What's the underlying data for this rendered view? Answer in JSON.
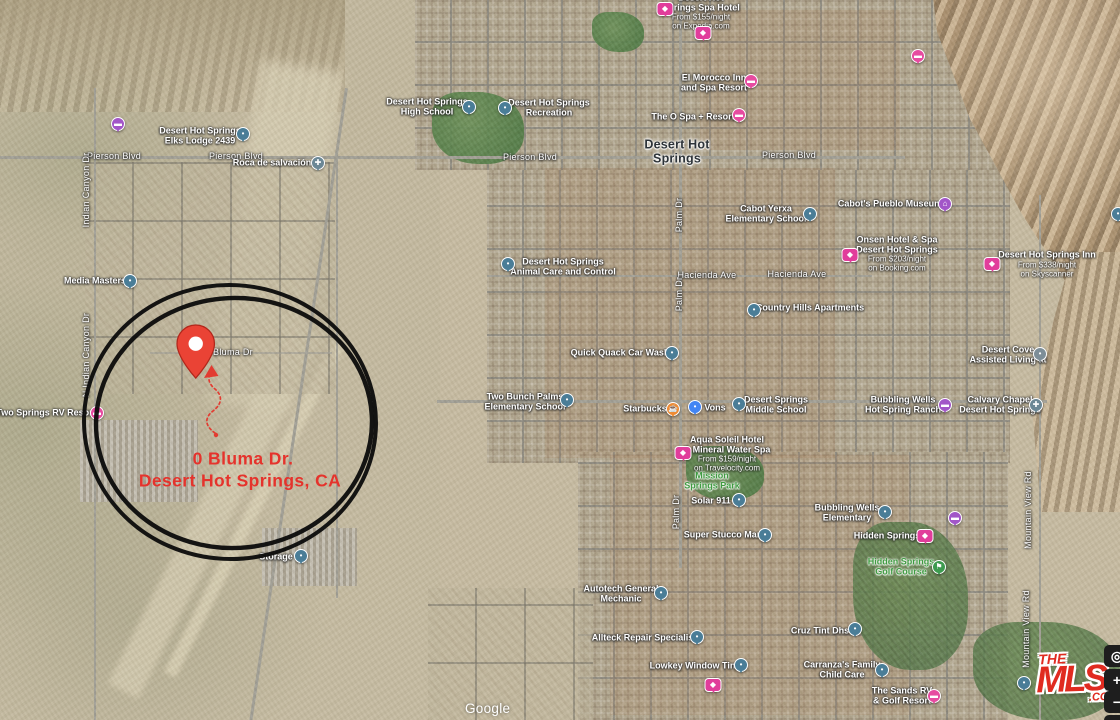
{
  "map": {
    "attribution": "Google",
    "city_label": {
      "lines": [
        "Desert Hot",
        "Springs"
      ]
    },
    "annotation": {
      "line1": "0 Bluma Dr.",
      "line2": "Desert Hot Springs, CA",
      "accent_color": "#e5332c",
      "marker_color": "#ea4335"
    },
    "logo": {
      "the": "THE",
      "mls": "MLS",
      "tm": "™",
      "com": ".COM",
      "color": "#e02b20"
    },
    "controls": {
      "zoom_in": "+",
      "zoom_out": "−"
    },
    "streets": [
      {
        "name": "Pierson Blvd",
        "x": 114,
        "y": 156
      },
      {
        "name": "Pierson Blvd",
        "x": 236,
        "y": 156
      },
      {
        "name": "Pierson Blvd",
        "x": 530,
        "y": 157
      },
      {
        "name": "Pierson Blvd",
        "x": 789,
        "y": 155
      },
      {
        "name": "Hacienda Ave",
        "x": 707,
        "y": 275
      },
      {
        "name": "Hacienda Ave",
        "x": 797,
        "y": 274
      },
      {
        "name": "Indian Canyon Dr",
        "x": 86,
        "y": 190,
        "v": true
      },
      {
        "name": "N Indian Canyon Dr",
        "x": 86,
        "y": 355,
        "v": true
      },
      {
        "name": "Palm Dr",
        "x": 679,
        "y": 215,
        "v": true
      },
      {
        "name": "Palm Dr",
        "x": 679,
        "y": 294,
        "v": true
      },
      {
        "name": "Palm Dr",
        "x": 676,
        "y": 512,
        "v": true
      },
      {
        "name": "Mountain View Rd",
        "x": 1028,
        "y": 510,
        "v": true
      },
      {
        "name": "Mountain View Rd",
        "x": 1026,
        "y": 629,
        "v": true
      },
      {
        "name": "Bluma Dr",
        "x": 233,
        "y": 352
      }
    ],
    "pois": [
      {
        "id": "elks-lodge",
        "lines": [
          "Desert Hot Springs",
          "Elks Lodge 2439"
        ],
        "x": 200,
        "y": 136,
        "pin": {
          "x": 243,
          "y": 134,
          "c": "#4a7d97",
          "g": "•"
        }
      },
      {
        "id": "roca-de-salvacion",
        "lines": [
          "Roca de salvación"
        ],
        "x": 272,
        "y": 163,
        "pin": {
          "x": 318,
          "y": 163,
          "c": "#6b8795",
          "g": "✚"
        }
      },
      {
        "id": "media-masters",
        "lines": [
          "Media Masters"
        ],
        "x": 95,
        "y": 281,
        "pin": {
          "x": 130,
          "y": 281,
          "c": "#4a7d97",
          "g": "•"
        }
      },
      {
        "id": "two-springs-rv-resort",
        "lines": [
          "Two Springs RV Resort"
        ],
        "x": 46,
        "y": 413,
        "pin": {
          "x": 97,
          "y": 413,
          "c": "#e64ba0",
          "g": "▬"
        }
      },
      {
        "id": "storage",
        "lines": [
          "Storage"
        ],
        "x": 276,
        "y": 557,
        "pin": {
          "x": 301,
          "y": 556,
          "c": "#4a7d97",
          "g": "•"
        }
      },
      {
        "id": "dhs-high-school",
        "lines": [
          "Desert Hot Springs",
          "High School"
        ],
        "x": 427,
        "y": 107,
        "pin": {
          "x": 469,
          "y": 107,
          "c": "#4a7d97",
          "g": "•"
        }
      },
      {
        "id": "dhs-recreation",
        "lines": [
          "Desert Hot Springs",
          "Recreation"
        ],
        "x": 549,
        "y": 108,
        "pin": {
          "x": 505,
          "y": 108,
          "c": "#4a7d97",
          "g": "•"
        }
      },
      {
        "id": "dhs-spa-hotel",
        "lines": [
          "Desert Hot",
          "Springs Spa Hotel"
        ],
        "sub": [
          "From $155/night",
          "on Expedia.com"
        ],
        "x": 701,
        "y": 12,
        "pin": {
          "x": 665,
          "y": 9,
          "c": "#e13d9b",
          "g": "◆",
          "sq": true
        }
      },
      {
        "id": "spa-hotel-2",
        "pin": {
          "x": 703,
          "y": 33,
          "c": "#e13d9b",
          "g": "◆",
          "sq": true
        }
      },
      {
        "id": "el-morocco-inn",
        "lines": [
          "El Morocco Inn",
          "and Spa Resort"
        ],
        "x": 714,
        "y": 83,
        "pin": {
          "x": 751,
          "y": 81,
          "c": "#e64ba0",
          "g": "▬"
        }
      },
      {
        "id": "the-o-spa",
        "lines": [
          "The O Spa + Resort"
        ],
        "x": 693,
        "y": 117,
        "pin": {
          "x": 739,
          "y": 115,
          "c": "#e64ba0",
          "g": "▬"
        }
      },
      {
        "id": "hotel-ne",
        "pin": {
          "x": 918,
          "y": 56,
          "c": "#e64ba0",
          "g": "▬"
        }
      },
      {
        "id": "cabots-pueblo-museum",
        "lines": [
          "Cabot's Pueblo Museum"
        ],
        "x": 890,
        "y": 204,
        "pin": {
          "x": 945,
          "y": 204,
          "c": "#a256c8",
          "g": "⌂"
        }
      },
      {
        "id": "cabot-yerxa-elementary",
        "lines": [
          "Cabot Yerxa",
          "Elementary School"
        ],
        "x": 766,
        "y": 214,
        "pin": {
          "x": 810,
          "y": 214,
          "c": "#4a7d97",
          "g": "•"
        }
      },
      {
        "id": "animal-care-control",
        "lines": [
          "Desert Hot Springs",
          "Animal Care and Control"
        ],
        "x": 563,
        "y": 267,
        "pin": {
          "x": 508,
          "y": 264,
          "c": "#4a7d97",
          "g": "•"
        }
      },
      {
        "id": "country-hills-apartments",
        "lines": [
          "Country Hills Apartments"
        ],
        "x": 810,
        "y": 308,
        "pin": {
          "x": 754,
          "y": 310,
          "c": "#4a7d97",
          "g": "•"
        }
      },
      {
        "id": "onsen-hotel-spa",
        "lines": [
          "Onsen Hotel & Spa",
          "Desert Hot Springs"
        ],
        "sub": [
          "From $203/night",
          "on Booking.com"
        ],
        "x": 897,
        "y": 254,
        "pin": {
          "x": 850,
          "y": 255,
          "c": "#e13d9b",
          "g": "◆",
          "sq": true
        }
      },
      {
        "id": "dhs-inn",
        "lines": [
          "Desert Hot Springs Inn"
        ],
        "sub": [
          "From $338/night",
          "on Skyscanner"
        ],
        "x": 1047,
        "y": 264,
        "pin": {
          "x": 992,
          "y": 264,
          "c": "#e13d9b",
          "g": "◆",
          "sq": true
        }
      },
      {
        "id": "quick-quack-car-wash",
        "lines": [
          "Quick Quack Car Wash"
        ],
        "x": 620,
        "y": 353,
        "pin": {
          "x": 672,
          "y": 353,
          "c": "#4a7d97",
          "g": "•"
        }
      },
      {
        "id": "two-bunch-palms-elementary",
        "lines": [
          "Two Bunch Palms",
          "Elementary School"
        ],
        "x": 525,
        "y": 402,
        "pin": {
          "x": 567,
          "y": 400,
          "c": "#4a7d97",
          "g": "•"
        }
      },
      {
        "id": "starbucks",
        "lines": [
          "Starbucks"
        ],
        "x": 645,
        "y": 409,
        "pin": {
          "x": 673,
          "y": 409,
          "c": "#ee8a33",
          "g": "☕"
        }
      },
      {
        "id": "vons",
        "lines": [
          "Vons"
        ],
        "x": 715,
        "y": 408,
        "pin": {
          "x": 695,
          "y": 407,
          "c": "#4285f4",
          "g": "•"
        }
      },
      {
        "id": "desert-springs-middle-school",
        "lines": [
          "Desert Springs",
          "Middle School"
        ],
        "x": 776,
        "y": 405,
        "pin": {
          "x": 739,
          "y": 404,
          "c": "#4a7d97",
          "g": "•"
        }
      },
      {
        "id": "desert-cove-assisted-living",
        "lines": [
          "Desert Cove",
          "Assisted Living at"
        ],
        "x": 1008,
        "y": 355,
        "pin": {
          "x": 1040,
          "y": 354,
          "c": "#7d8e98",
          "g": "•"
        }
      },
      {
        "id": "bubbling-wells-ranch",
        "lines": [
          "Bubbling Wells",
          "Hot Spring Ranch"
        ],
        "x": 903,
        "y": 405,
        "pin": {
          "x": 945,
          "y": 405,
          "c": "#a256c8",
          "g": "▬"
        }
      },
      {
        "id": "calvary-chapel",
        "lines": [
          "Calvary Chapel",
          "Desert Hot Springs"
        ],
        "x": 1000,
        "y": 405,
        "pin": {
          "x": 1036,
          "y": 405,
          "c": "#6b8795",
          "g": "✚"
        }
      },
      {
        "id": "aqua-soleil-hotel",
        "lines": [
          "Aqua Soleil Hotel",
          "& Mineral Water Spa"
        ],
        "sub": [
          "From $159/night",
          "on Travelocity.com"
        ],
        "x": 727,
        "y": 454,
        "pin": {
          "x": 683,
          "y": 453,
          "c": "#e13d9b",
          "g": "◆",
          "sq": true
        }
      },
      {
        "id": "mission-springs-park",
        "lines": [
          "Mission",
          "Springs Park"
        ],
        "x": 712,
        "y": 481,
        "cls": "greenlbl"
      },
      {
        "id": "solar-911",
        "lines": [
          "Solar 911"
        ],
        "x": 711,
        "y": 501,
        "pin": {
          "x": 739,
          "y": 500,
          "c": "#4a7d97",
          "g": "•"
        }
      },
      {
        "id": "super-stucco-man",
        "lines": [
          "Super Stucco Man"
        ],
        "x": 723,
        "y": 535,
        "pin": {
          "x": 765,
          "y": 535,
          "c": "#4a7d97",
          "g": "•"
        }
      },
      {
        "id": "bubbling-wells-elementary",
        "lines": [
          "Bubbling Wells",
          "Elementary"
        ],
        "x": 847,
        "y": 513,
        "pin": {
          "x": 885,
          "y": 512,
          "c": "#4a7d97",
          "g": "•"
        }
      },
      {
        "id": "hidden-springs",
        "lines": [
          "Hidden Springs"
        ],
        "x": 887,
        "y": 536,
        "pin": {
          "x": 925,
          "y": 536,
          "c": "#e13d9b",
          "g": "◆",
          "sq": true
        }
      },
      {
        "id": "lodging-hidden",
        "pin": {
          "x": 955,
          "y": 518,
          "c": "#a256c8",
          "g": "▬"
        }
      },
      {
        "id": "hidden-springs-golf",
        "lines": [
          "Hidden Springs",
          "Golf Course"
        ],
        "x": 901,
        "y": 567,
        "cls": "greenlbl",
        "pin": {
          "x": 939,
          "y": 567,
          "c": "#3d9b4f",
          "g": "⚑"
        }
      },
      {
        "id": "autotech-general-mechanic",
        "lines": [
          "Autotech General",
          "Mechanic"
        ],
        "x": 621,
        "y": 594,
        "pin": {
          "x": 661,
          "y": 593,
          "c": "#4a7d97",
          "g": "•"
        }
      },
      {
        "id": "allteck-repair",
        "lines": [
          "Allteck Repair Specialist"
        ],
        "x": 644,
        "y": 638,
        "pin": {
          "x": 697,
          "y": 637,
          "c": "#4a7d97",
          "g": "•"
        }
      },
      {
        "id": "lowkey-window-tint",
        "lines": [
          "Lowkey Window Tint"
        ],
        "x": 694,
        "y": 666,
        "pin": {
          "x": 741,
          "y": 665,
          "c": "#4a7d97",
          "g": "•"
        }
      },
      {
        "id": "hotel-s",
        "pin": {
          "x": 713,
          "y": 685,
          "c": "#e13d9b",
          "g": "◆",
          "sq": true
        }
      },
      {
        "id": "cruz-tint-dhs",
        "lines": [
          "Cruz Tint Dhs"
        ],
        "x": 820,
        "y": 631,
        "pin": {
          "x": 855,
          "y": 629,
          "c": "#4a7d97",
          "g": "•"
        }
      },
      {
        "id": "carranzas-child-care",
        "lines": [
          "Carranza's Family",
          "Child Care"
        ],
        "x": 842,
        "y": 670,
        "pin": {
          "x": 882,
          "y": 670,
          "c": "#4a7d97",
          "g": "•"
        }
      },
      {
        "id": "sands-rv-golf-resort",
        "lines": [
          "The Sands RV",
          "& Golf Resort"
        ],
        "x": 902,
        "y": 696,
        "pin": {
          "x": 934,
          "y": 696,
          "c": "#e64ba0",
          "g": "▬"
        }
      },
      {
        "id": "poi-se",
        "pin": {
          "x": 1024,
          "y": 683,
          "c": "#4a7d97",
          "g": "•"
        }
      },
      {
        "id": "lodging-nw",
        "pin": {
          "x": 118,
          "y": 124,
          "c": "#a256c8",
          "g": "▬"
        }
      },
      {
        "id": "poi-edge-e",
        "pin": {
          "x": 1118,
          "y": 214,
          "c": "#4a7d97",
          "g": "•"
        }
      }
    ]
  }
}
